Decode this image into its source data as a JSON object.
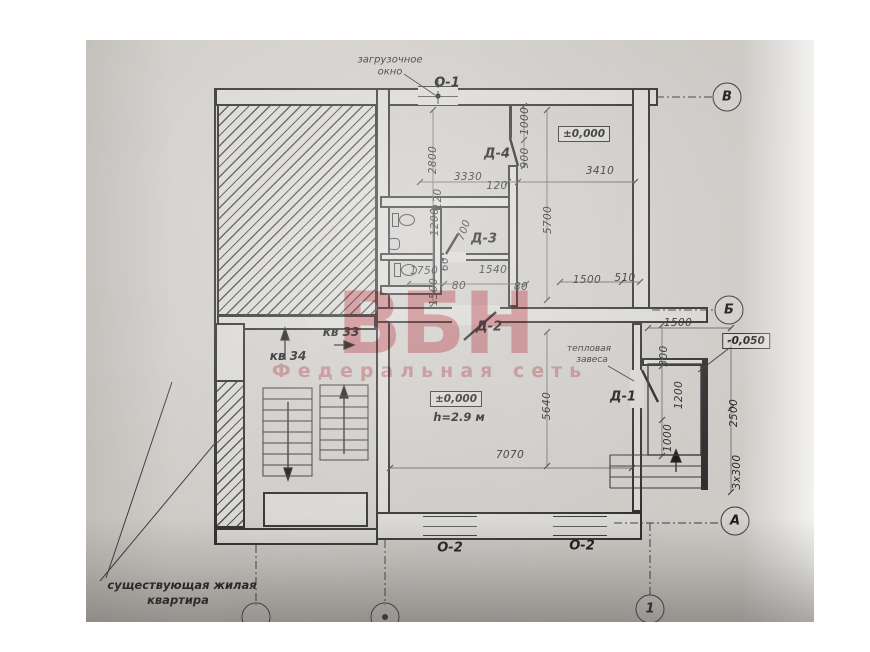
{
  "watermark": {
    "logo": "ВБН",
    "subtitle": "Федеральная сеть",
    "color": "#e5808a"
  },
  "plan": {
    "loading_window": {
      "line1": "загрузочное",
      "line2": "окно"
    },
    "windows": {
      "o1": "О-1",
      "o2_left": "О-2",
      "o2_right": "О-2"
    },
    "doors": {
      "d1": "Д-1",
      "d2": "Д-2",
      "d3": "Д-3",
      "d4": "Д-4"
    },
    "rooms": {
      "apartment_34": "кв 34",
      "apartment_33": "кв 33",
      "existing_line1": "существующая жилая",
      "existing_line2": "квартира",
      "thermal_line1": "тепловая",
      "thermal_line2": "завеса"
    },
    "levels": {
      "zero_top": "±0,000",
      "zero_main": "±0,000",
      "minus": "-0,050",
      "height": "h=2.9 м"
    },
    "axes": {
      "v": "В",
      "b": "Б",
      "a": "А",
      "one": "1"
    },
    "dimensions": [
      {
        "text": "2800",
        "x": 347,
        "y": 120,
        "rot": -90
      },
      {
        "text": "3330",
        "x": 382,
        "y": 137,
        "rot": 0
      },
      {
        "text": "120",
        "x": 411,
        "y": 146,
        "rot": 0
      },
      {
        "text": "120",
        "x": 352,
        "y": 159,
        "rot": -90
      },
      {
        "text": "1000",
        "x": 439,
        "y": 81,
        "rot": -90
      },
      {
        "text": "900",
        "x": 439,
        "y": 118,
        "rot": -90
      },
      {
        "text": "3410",
        "x": 514,
        "y": 131,
        "rot": 0
      },
      {
        "text": "1200",
        "x": 349,
        "y": 182,
        "rot": -90
      },
      {
        "text": "700",
        "x": 378,
        "y": 190,
        "rot": -70
      },
      {
        "text": "1750",
        "x": 338,
        "y": 231,
        "rot": 0
      },
      {
        "text": "60",
        "x": 359,
        "y": 224,
        "rot": -90
      },
      {
        "text": "80",
        "x": 373,
        "y": 246,
        "rot": 0
      },
      {
        "text": "1540",
        "x": 407,
        "y": 230,
        "rot": 0
      },
      {
        "text": "80",
        "x": 435,
        "y": 247,
        "rot": 0
      },
      {
        "text": "1500",
        "x": 348,
        "y": 252,
        "rot": -90
      },
      {
        "text": "5700",
        "x": 462,
        "y": 180,
        "rot": -90
      },
      {
        "text": "1500",
        "x": 501,
        "y": 240,
        "rot": 0
      },
      {
        "text": "510",
        "x": 539,
        "y": 238,
        "rot": 0
      },
      {
        "text": "5640",
        "x": 461,
        "y": 366,
        "rot": -90
      },
      {
        "text": "7070",
        "x": 424,
        "y": 415,
        "rot": 0
      },
      {
        "text": "1500",
        "x": 592,
        "y": 283,
        "rot": 0
      },
      {
        "text": "300",
        "x": 578,
        "y": 316,
        "rot": -90
      },
      {
        "text": "1200",
        "x": 593,
        "y": 355,
        "rot": -90
      },
      {
        "text": "2500",
        "x": 648,
        "y": 373,
        "rot": -90
      },
      {
        "text": "1000",
        "x": 582,
        "y": 398,
        "rot": -90
      },
      {
        "text": "3x300",
        "x": 651,
        "y": 432,
        "rot": -90
      }
    ]
  }
}
